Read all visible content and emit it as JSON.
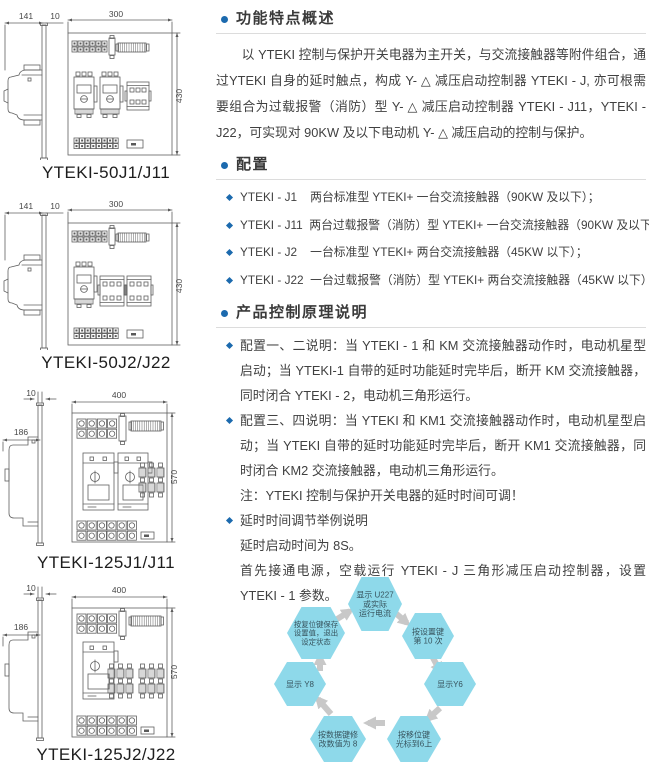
{
  "page": {
    "background": "#ffffff"
  },
  "colors": {
    "accent_blue": "#1c6aae",
    "heading_text": "#3a3a3a",
    "body_text": "#404040",
    "divider": "#dcdcdc",
    "diagram_line": "#606060",
    "dim_text": "#474747",
    "hex_fill": "#8ed9ea",
    "hex_text": "#37535d",
    "arrow_gray": "#c8c8c8"
  },
  "diagrams": [
    {
      "caption": "YTEKI-50J1/J11",
      "variant": "50-dual",
      "dims": {
        "depth": "141",
        "plate": "10",
        "width": "300",
        "height": "430"
      }
    },
    {
      "caption": "YTEKI-50J2/J22",
      "variant": "50-single",
      "dims": {
        "depth": "141",
        "plate": "10",
        "width": "300",
        "height": "430"
      }
    },
    {
      "caption": "YTEKI-125J1/J11",
      "variant": "125-dual",
      "dims": {
        "depth": "186",
        "plate": "10",
        "width": "400",
        "height": "570"
      }
    },
    {
      "caption": "YTEKI-125J2/J22",
      "variant": "125-single",
      "dims": {
        "depth": "186",
        "plate": "10",
        "width": "400",
        "height": "570"
      }
    }
  ],
  "sections": {
    "features": {
      "title": "功能特点概述",
      "body": "以 YTEKI 控制与保护开关电器为主开关，与交流接触器等附件组合，通过YTEKI 自身的延时触点，构成 Y- △ 减压启动控制器 YTEKI - J, 亦可根需要组合为过载报警（消防）型 Y- △ 减压启动控制器 YTEKI - J11，YTEKI - J22，可实现对 90KW 及以下电动机 Y- △ 减压启动的控制与保护。"
    },
    "config": {
      "title": "配置",
      "items": [
        "YTEKI - J1    两台标准型 YTEKI+ 一台交流接触器（90KW 及以下）；",
        "YTEKI - J11  两台过载报警（消防）型 YTEKI+ 一台交流接触器（90KW 及以下）；",
        "YTEKI - J2    一台标准型 YTEKI+ 两台交流接触器（45KW 以下）；",
        "YTEKI - J22  一台过载报警（消防）型 YTEKI+ 两台交流接触器（45KW 以下）"
      ]
    },
    "principle": {
      "title": "产品控制原理说明",
      "items": [
        {
          "text": "配置一、二说明：当 YTEKI - 1 和 KM 交流接触器动作时，电动机星型启动；当 YTEKI-1 自带的延时功能延时完毕后，断开 KM 交流接触器，同时闭合 YTEKI - 2，电动机三角形运行。"
        },
        {
          "text": "配置三、四说明：当 YTEKI 和 KM1 交流接触器动作时，电动机星型启动；当 YTEKI 自带的延时功能延时完毕后，断开 KM1 交流接触器，同时闭合 KM2 交流接触器，电动机三角形运行。",
          "note": "注：YTEKI 控制与保护开关电器的延时时间可调！"
        },
        {
          "text": "延时时间调节举例说明",
          "sub": [
            "延时启动时间为 8S。",
            "首先接通电源，空载运行 YTEKI - J 三角形减压启动控制器，设置 YTEKI - 1 参数。"
          ]
        }
      ]
    }
  },
  "flow": {
    "nodes": [
      {
        "id": "display-current",
        "lines": [
          "显示 U227",
          "或实际",
          "运行电流"
        ]
      },
      {
        "id": "press-set-key",
        "lines": [
          "按设置键",
          "第 10 次"
        ]
      },
      {
        "id": "display-y6",
        "lines": [
          "显示Y6"
        ]
      },
      {
        "id": "press-shift-key",
        "lines": [
          "按移位键",
          "光标到6上"
        ]
      },
      {
        "id": "press-data-key",
        "lines": [
          "按数据键修",
          "改数值为 8"
        ]
      },
      {
        "id": "display-y8",
        "lines": [
          "显示 Y8"
        ]
      },
      {
        "id": "press-reset-key",
        "lines": [
          "按复位键保存",
          "设置值，退出",
          "设定状态"
        ]
      }
    ]
  }
}
